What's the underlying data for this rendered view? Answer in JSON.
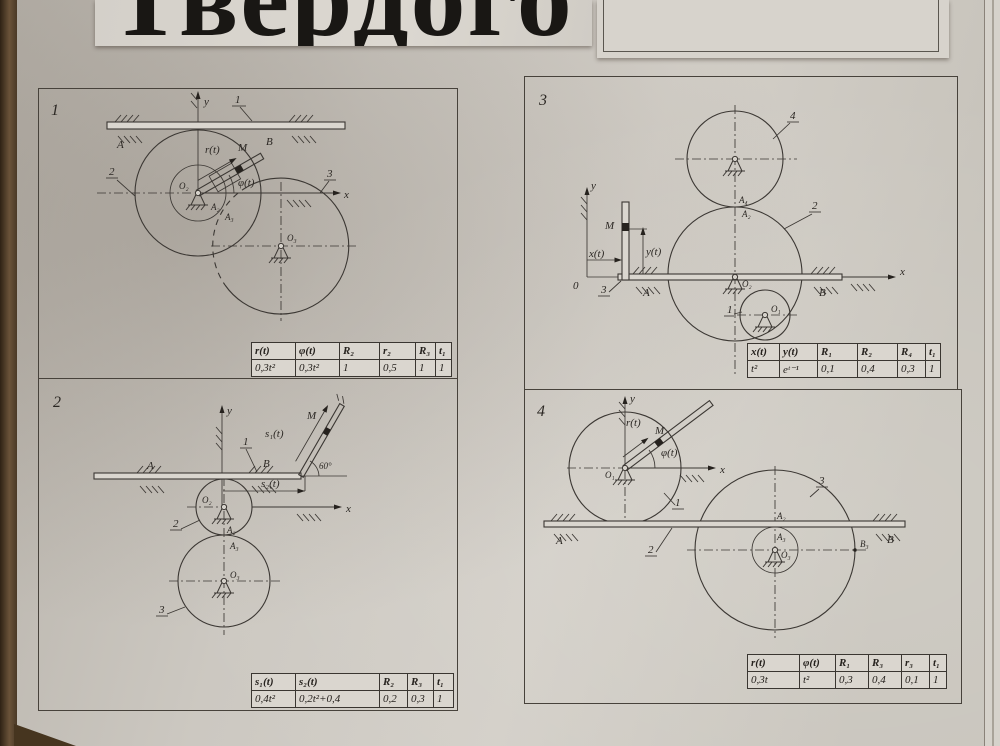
{
  "photo": {
    "heading": "Твердого",
    "colors": {
      "wood": "#5e4a33",
      "paper": "#ccc8c1",
      "ink": "#3b3733"
    }
  },
  "panels": [
    {
      "number": "1",
      "labels": {
        "axis_y": "y",
        "axis_x": "x",
        "body1": "1",
        "body2": "2",
        "body3": "3",
        "A": "A",
        "B": "B",
        "M": "M",
        "rt": "r(t)",
        "phit": "φ(t)",
        "O2": "O₂",
        "O3": "O₃",
        "A2": "A₂",
        "A3": "A₃"
      },
      "table": {
        "headers": [
          "r(t)",
          "φ(t)",
          "R₂",
          "r₂",
          "R₃",
          "t₁"
        ],
        "values": [
          "0,3t²",
          "0,3t²",
          "1",
          "0,5",
          "1",
          "1"
        ]
      }
    },
    {
      "number": "2",
      "labels": {
        "axis_y": "y",
        "axis_x": "x",
        "body1": "1",
        "body2": "2",
        "body3": "3",
        "A": "A",
        "B": "B",
        "M": "M",
        "s1t": "s₁(t)",
        "s2t": "s₂(t)",
        "angle": "60°",
        "O2": "O₂",
        "O3": "O₃",
        "A2": "A₂",
        "A3": "A₃"
      },
      "table": {
        "headers": [
          "s₁(t)",
          "s₂(t)",
          "R₂",
          "R₃",
          "t₁"
        ],
        "values": [
          "0,4t²",
          "0,2t²+0,4",
          "0,2",
          "0,3",
          "1"
        ]
      }
    },
    {
      "number": "3",
      "labels": {
        "axis_y": "y",
        "axis_x": "x",
        "origin": "0",
        "body1": "1",
        "body2": "2",
        "body3": "3",
        "body4": "4",
        "A": "A",
        "B": "B",
        "M": "M",
        "xt": "x(t)",
        "yt": "y(t)",
        "O1": "O₁",
        "O2": "O₂",
        "A4": "A₄",
        "A2": "A₂"
      },
      "table": {
        "headers": [
          "x(t)",
          "y(t)",
          "R₁",
          "R₂",
          "R₄",
          "t₁"
        ],
        "values": [
          "t²",
          "eᵗ⁻¹",
          "0,1",
          "0,4",
          "0,3",
          "1"
        ]
      }
    },
    {
      "number": "4",
      "labels": {
        "axis_y": "y",
        "axis_x": "x",
        "body1": "1",
        "body2": "2",
        "body3": "3",
        "A": "A",
        "B": "B",
        "M": "M",
        "rt": "r(t)",
        "phit": "φ(t)",
        "O1": "O₁",
        "O3": "O₃",
        "A2": "A₂",
        "A3": "A₃",
        "B3": "B₃"
      },
      "table": {
        "headers": [
          "r(t)",
          "φ(t)",
          "R₁",
          "R₃",
          "r₃",
          "t₁"
        ],
        "values": [
          "0,3t",
          "t²",
          "0,3",
          "0,4",
          "0,1",
          "1"
        ]
      }
    }
  ]
}
